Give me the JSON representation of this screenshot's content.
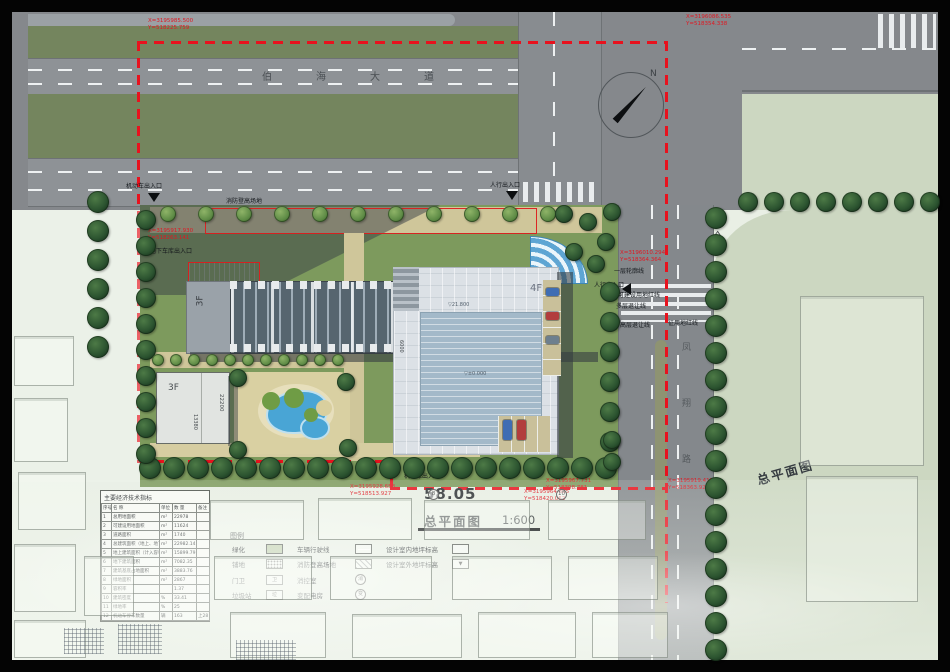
{
  "title_block": {
    "drawing_title": "总平面图",
    "scale": "1:600",
    "side_label": "总平面图",
    "big_dim": "58.05"
  },
  "compass": {
    "label": "N"
  },
  "roads": {
    "main_chars": [
      "伯",
      "海",
      "大",
      "道"
    ],
    "side_chars": [
      "凤",
      "翔",
      "路"
    ]
  },
  "dims": {
    "curve": "37.7",
    "small_bldg_v": "22200",
    "small_bldg_h": "13380",
    "mid_v": "6000"
  },
  "buildings": {
    "main_left": "3F",
    "small": "3F",
    "tower": "4F",
    "elev_top": "▽21.800",
    "elev_center": "▽±0.000"
  },
  "annotations": {
    "vehicle_entrance_n": "机动车出入口",
    "vehicle_entrance_s": "机动车出入口",
    "pedestrian_entrance_n": "人行出入口",
    "pedestrian_entrance_e": "人行出入口",
    "garage_entrance": "地下车库出入口",
    "fire_area": "消防登高场地",
    "first_floor_outline": "一层轮廓线",
    "buildable_red_line": "可建设用地红线",
    "multi_setback": "多层退让线",
    "highrise_setback": "高层退让线",
    "land_red_line": "征用地红线",
    "axis_bubble_1": "8",
    "axis_bubble_2": "10"
  },
  "coords": [
    {
      "x_label": "X=3195985.500",
      "y_label": "Y=518225.759"
    },
    {
      "x_label": "X=3196086.535",
      "y_label": "Y=518354.338"
    },
    {
      "x_label": "X=3196010.294",
      "y_label": "Y=518364.364"
    },
    {
      "x_label": "X=3195917.930",
      "y_label": "Y=518263.141"
    },
    {
      "x_label": "X=3195967.731",
      "y_label": "Y=518398.781"
    },
    {
      "x_label": "X=3195928.658",
      "y_label": "Y=518513.927"
    },
    {
      "x_label": "X=3195964.895",
      "y_label": "Y=518420.062"
    },
    {
      "x_label": "X=3195919.415",
      "y_label": "Y=518363.927"
    }
  ],
  "legend": {
    "title": "图例",
    "items": [
      {
        "label": "绿化"
      },
      {
        "label": "铺地"
      },
      {
        "label": "门卫",
        "mark": "卫"
      },
      {
        "label": "垃圾站",
        "mark": "垃"
      },
      {
        "label": "车辆行驶线"
      },
      {
        "label": "消防登高场地"
      },
      {
        "label": "消控室",
        "mark": "消"
      },
      {
        "label": "变配电房",
        "mark": "变"
      },
      {
        "label": "设计室内地坪标高"
      },
      {
        "label": "设计室外地坪标高"
      }
    ]
  },
  "table": {
    "title": "主要经济技术指标",
    "headers": [
      "序号",
      "名  称",
      "单位",
      "数  量",
      "备注"
    ],
    "rows": [
      [
        "1",
        "总用地面积",
        "m²",
        "22978",
        ""
      ],
      [
        "2",
        "可建设用地面积",
        "m²",
        "11624",
        ""
      ],
      [
        "3",
        "道路面积",
        "m²",
        "1740",
        ""
      ],
      [
        "4",
        "总建筑面积（地上、地下）",
        "m²",
        "22982.14",
        ""
      ],
      [
        "5",
        "地上建筑面积（计入容积率）",
        "m²",
        "15899.79",
        ""
      ],
      [
        "6",
        "地下建筑面积",
        "m²",
        "7082.35",
        ""
      ],
      [
        "7",
        "建筑基底占地面积",
        "m²",
        "3883.76",
        ""
      ],
      [
        "8",
        "绿地面积",
        "m²",
        "2867",
        ""
      ],
      [
        "9",
        "容积率",
        "",
        "1.37",
        ""
      ],
      [
        "10",
        "建筑密度",
        "%",
        "33.41",
        ""
      ],
      [
        "11",
        "绿地率",
        "%",
        "25",
        ""
      ],
      [
        "12",
        "机动车停车数量",
        "辆",
        "163",
        "上28 下135"
      ]
    ]
  }
}
